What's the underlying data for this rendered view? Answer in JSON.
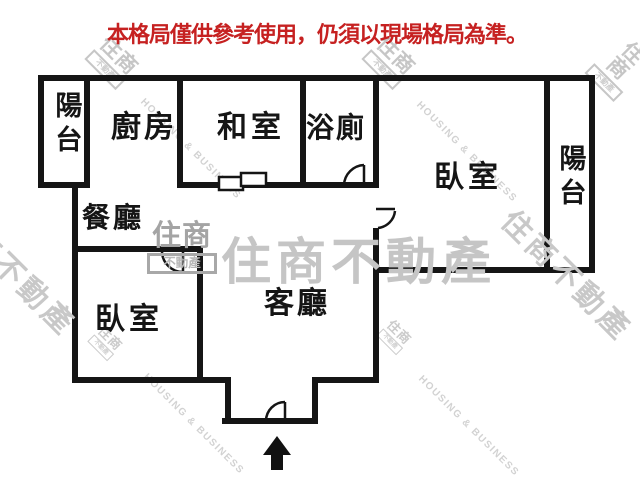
{
  "disclaimer": "本格局僅供參考使用，仍須以現場格局為準。",
  "rooms": {
    "balcony_left": "陽台",
    "kitchen": "廚房",
    "tatami_room": "和室",
    "bathroom": "浴廁",
    "bedroom_right": "臥室",
    "balcony_right": "陽台",
    "dining_room": "餐廳",
    "bedroom_left": "臥室",
    "living_room": "客廳"
  },
  "watermarks": {
    "brand_cjk": "住商不動產",
    "brand_en": "HOUSING & BUSINESS",
    "logo_top": "住商",
    "logo_bottom": "不動產"
  },
  "colors": {
    "wall": "#151515",
    "disclaimer_red": "#c62121",
    "watermark_gray": "#c5c5c5",
    "watermark_light": "#d2d2d2"
  }
}
